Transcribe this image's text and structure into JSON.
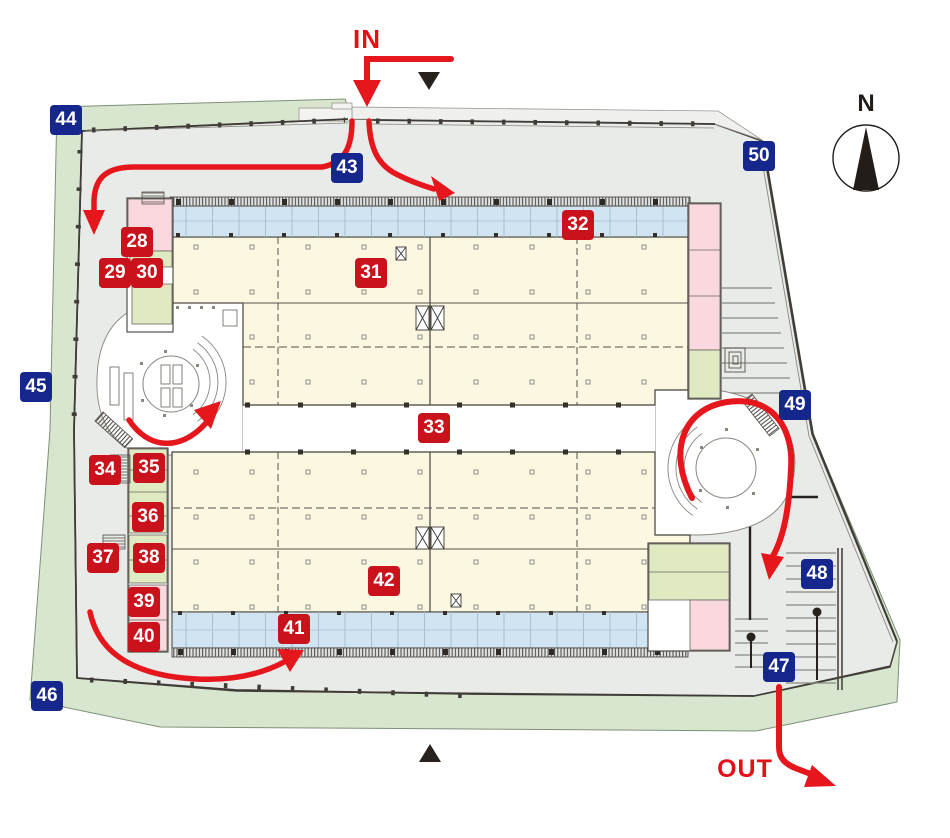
{
  "map": {
    "flow_labels": {
      "in": "IN",
      "out": "OUT"
    },
    "compass": {
      "north": "N"
    },
    "markers": {
      "m28": "28",
      "m29": "29",
      "m30": "30",
      "m31": "31",
      "m32": "32",
      "m33": "33",
      "m34": "34",
      "m35": "35",
      "m36": "36",
      "m37": "37",
      "m38": "38",
      "m39": "39",
      "m40": "40",
      "m41": "41",
      "m42": "42",
      "m43": "43",
      "m44": "44",
      "m45": "45",
      "m46": "46",
      "m47": "47",
      "m48": "48",
      "m49": "49",
      "m50": "50"
    },
    "colors": {
      "red_marker": "#c9121b",
      "blue_marker": "#15278c",
      "route_red": "#e6161d",
      "site_gray": "#e9ebe8",
      "site_green": "#d8e6d0",
      "hall_cream": "#fbf7e1",
      "dock_blue": "#d0e4f2",
      "room_pink": "#f9d9de",
      "room_green": "#dfe9c2"
    }
  }
}
